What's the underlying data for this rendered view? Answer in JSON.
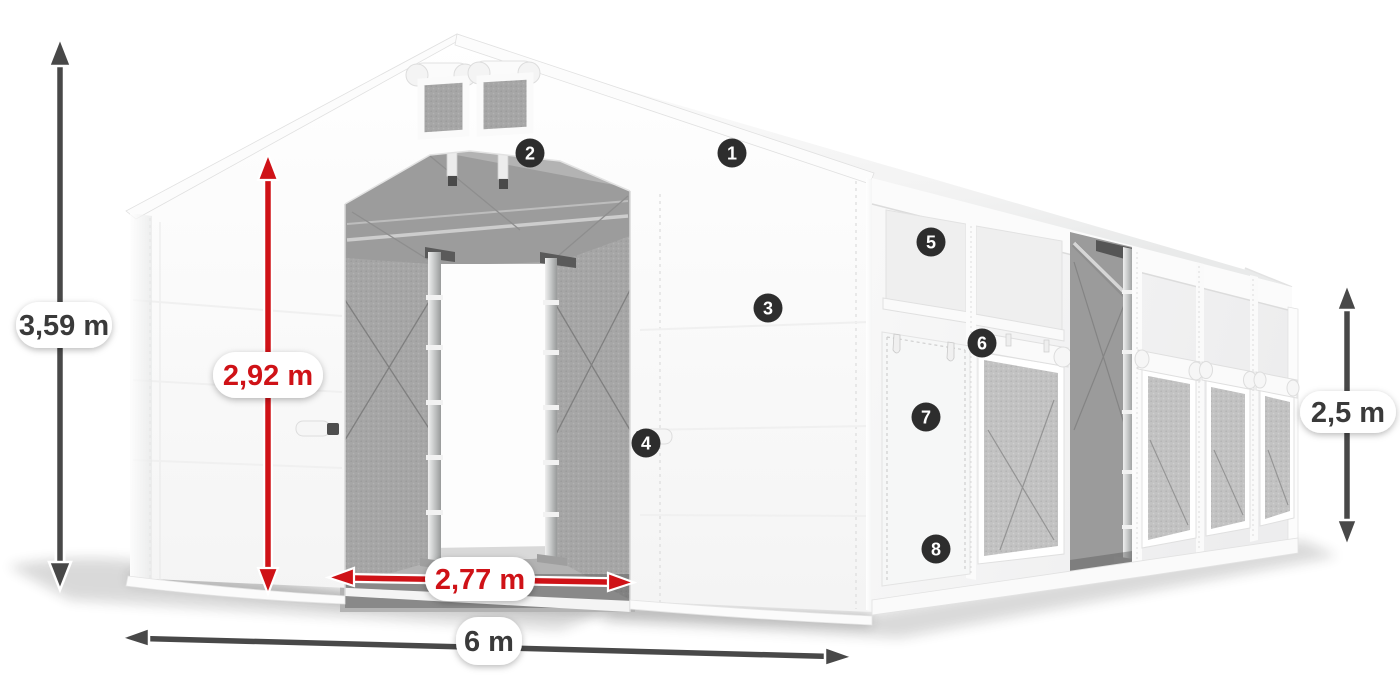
{
  "scene": {
    "type": "product-dimension-diagram",
    "subject": "white tarpaulin storage tent, three-quarter view, open front entrance, side door and mesh windows",
    "background": "#ffffff"
  },
  "colors": {
    "arrow_dark": "#484848",
    "arrow_red": "#cf1217",
    "pill_background": "#ffffff",
    "pill_text_dark": "#3a3a3a",
    "pill_text_red": "#cf1217",
    "marker_background": "#2d2d2d",
    "marker_text": "#ffffff",
    "tent_white": "#fbfbfb",
    "interior_gray": "#a6a6a6",
    "mesh_gray": "#c2c2c2"
  },
  "dimensions": {
    "total_height": {
      "label": "3,59 m",
      "style": "dark",
      "axis": "vertical",
      "location": "far-left"
    },
    "entrance_height": {
      "label": "2,92 m",
      "style": "red",
      "axis": "vertical",
      "location": "front-entrance"
    },
    "entrance_width": {
      "label": "2,77 m",
      "style": "red",
      "axis": "horizontal",
      "location": "front-entrance-base"
    },
    "tent_width": {
      "label": "6 m",
      "style": "dark",
      "axis": "horizontal",
      "location": "bottom-front"
    },
    "side_height": {
      "label": "2,5 m",
      "style": "dark",
      "axis": "vertical",
      "location": "far-right"
    }
  },
  "markers": [
    {
      "number": "1"
    },
    {
      "number": "2"
    },
    {
      "number": "3"
    },
    {
      "number": "4"
    },
    {
      "number": "5"
    },
    {
      "number": "6"
    },
    {
      "number": "7"
    },
    {
      "number": "8"
    }
  ]
}
